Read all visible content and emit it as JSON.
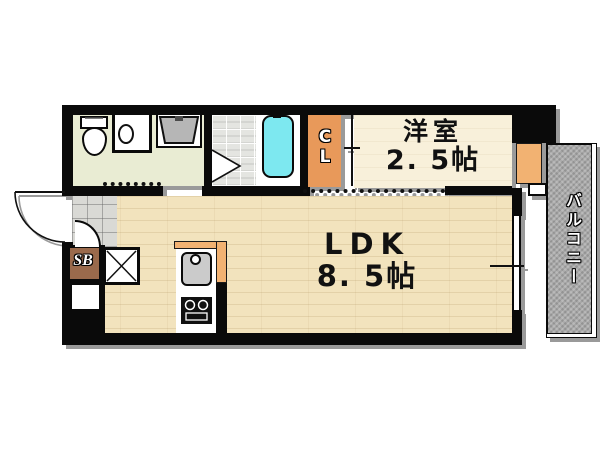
{
  "plan_title": "apartment-floor-plan",
  "rooms": {
    "western_room": {
      "name": "洋室",
      "size": "2. 5帖"
    },
    "ldk": {
      "name": "LDK",
      "size": "8. 5帖"
    },
    "closet": {
      "abbr": "CL"
    },
    "shoe_box": {
      "abbr": "SB"
    },
    "balcony": {
      "name": "バルコニー"
    }
  },
  "colors": {
    "wall": "#0a0a0a",
    "closet_fill": "#e8995a",
    "kitchen_counter_fill": "#f2b272",
    "bathtub_fill": "#7de8f0",
    "ldk_floor": "#f2e3bd",
    "western_room_floor": "#f8f0da",
    "washroom_floor": "#e9ecd3",
    "entrance_tile": "#d9d9d5",
    "balcony_fill": "#ababab",
    "shoe_box_fill": "#9a6a4c"
  },
  "fixtures": [
    "toilet",
    "washbasin",
    "washing-machine-pan",
    "shower-room",
    "bathtub",
    "kitchen-sink",
    "stove",
    "refrigerator-space",
    "entrance-door",
    "window"
  ]
}
